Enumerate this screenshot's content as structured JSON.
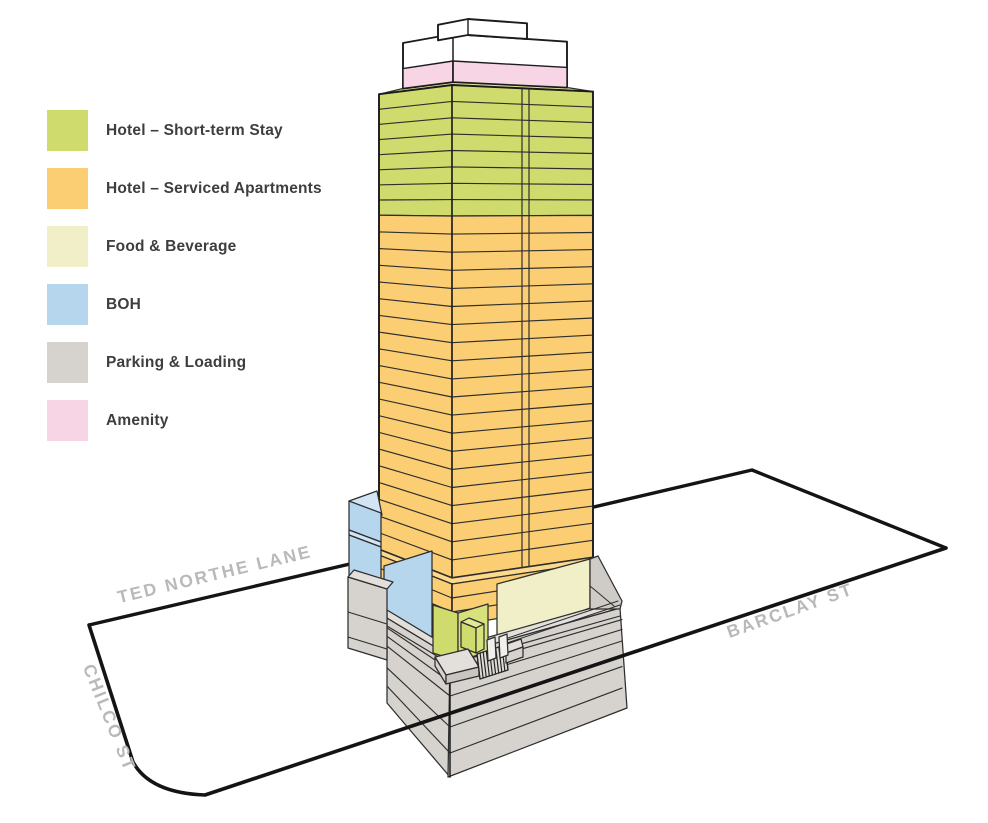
{
  "palette": {
    "green": "#d0db6e",
    "greenRight": "#d8e27c",
    "greenTop": "#e2e994",
    "orange": "#fbce73",
    "orangeTop": "#fdd98c",
    "cream": "#f1efc7",
    "blue": "#b6d6ee",
    "blueTop": "#d3e5f4",
    "gray": "#d6d2ce",
    "grayLight": "#e3e0db",
    "grayMid": "#cfccc7",
    "grayDark": "#c9c5c1",
    "pink": "#f8d5e5",
    "white": "#ffffff",
    "line": "#2e2e2e",
    "outline": "#1c1c1c",
    "street": "#141414",
    "streetLabel": "#b9b9b9",
    "legendText": "#3e3e3e"
  },
  "legend": {
    "items": [
      {
        "label": "Hotel – Short-term Stay",
        "colorKey": "green"
      },
      {
        "label": "Hotel – Serviced Apartments",
        "colorKey": "orange"
      },
      {
        "label": "Food & Beverage",
        "colorKey": "cream"
      },
      {
        "label": "BOH",
        "colorKey": "blue"
      },
      {
        "label": "Parking & Loading",
        "colorKey": "gray"
      },
      {
        "label": "Amenity",
        "colorKey": "pink"
      }
    ]
  },
  "streets": {
    "ted_northe": "TED NORTHE LANE",
    "barclay": "BARCLAY ST",
    "chilco": "CHILCO ST"
  },
  "building": {
    "crown_use": "Amenity",
    "tower_sections": [
      {
        "use": "Hotel – Short-term Stay",
        "colorKey": "green",
        "floors": 8
      },
      {
        "use": "Hotel – Serviced Apartments",
        "colorKey": "orange",
        "floors": 20
      }
    ],
    "ledge_use": "Hotel – Serviced Apartments",
    "base_uses": [
      "BOH",
      "Food & Beverage"
    ],
    "podium_use": "Parking & Loading"
  }
}
